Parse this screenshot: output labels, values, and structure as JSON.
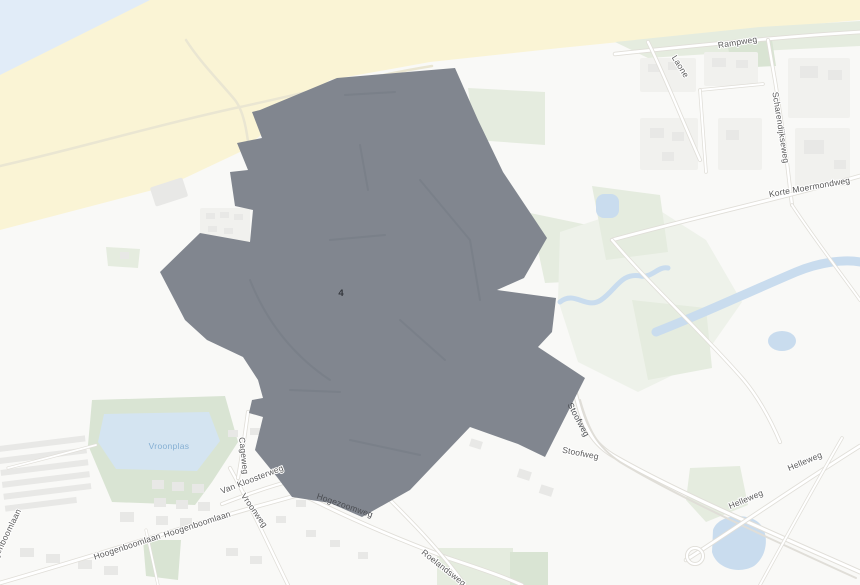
{
  "map": {
    "zone": {
      "label": "4"
    },
    "road_labels": {
      "rampweg": "Rampweg",
      "laone": "Laone",
      "scharendijkseweg": "Scharendijkseweg",
      "korte_moermondweg": "Korte Moermondweg",
      "stoofweg": "Stoofweg",
      "helleweg": "Helleweg",
      "roelandsweg": "Roelandsweg",
      "hogezoomweg": "Hogezoomweg",
      "vroonweg": "Vroonweg",
      "van_kloosterweg": "Van Kloosterweg",
      "cageweg": "Cageweg",
      "hoogenboomlaan": "Hoogenboomlaan"
    },
    "water_labels": {
      "vroonplas": "Vroonplas"
    },
    "colors": {
      "sea": "#E1ECF8",
      "sand": "#FAF4D5",
      "grass": "#E5ECDF",
      "lake": "#D4E4F1",
      "pond": "#C9DCEE",
      "building": "#E8E8E6",
      "background": "#F9F9F7",
      "zone_fill": "#81868F",
      "zone_text": "#34373D",
      "road_label": "#595959",
      "water_label": "#85AFD3"
    }
  }
}
